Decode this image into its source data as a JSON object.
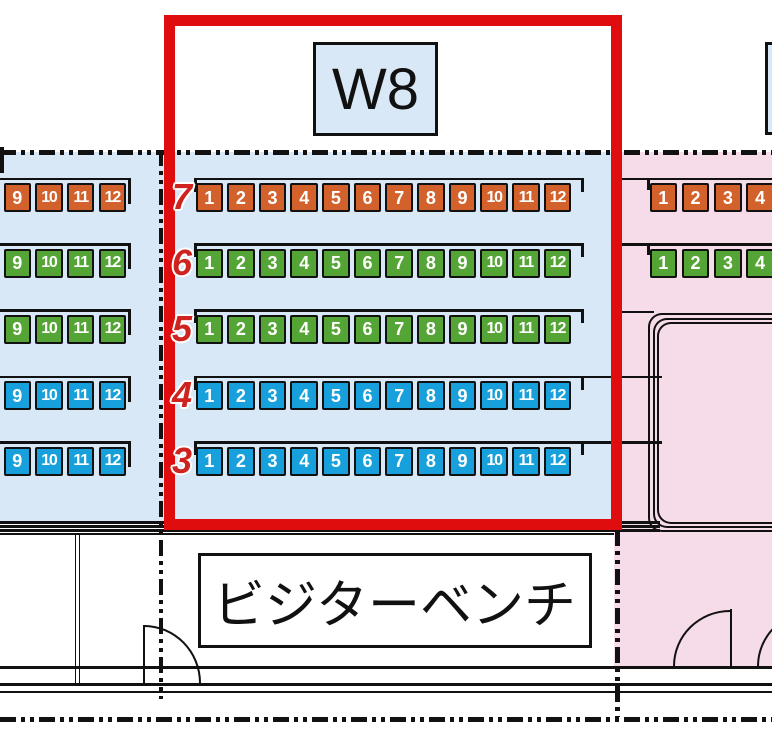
{
  "map": {
    "section_label": "W8",
    "bench_label": "ビジターベンチ",
    "row_numbers": [
      "7",
      "6",
      "5",
      "4",
      "3"
    ],
    "row_colors": [
      "orange",
      "green",
      "green",
      "blue",
      "blue"
    ],
    "left_seats": [
      "9",
      "10",
      "11",
      "12"
    ],
    "main_seats": [
      "1",
      "2",
      "3",
      "4",
      "5",
      "6",
      "7",
      "8",
      "9",
      "10",
      "11",
      "12"
    ],
    "right_seats": [
      "1",
      "2",
      "3",
      "4"
    ],
    "right_rows_present": [
      0,
      1
    ]
  },
  "colors": {
    "orange": "#d2612c",
    "green": "#55a536",
    "blue": "#17a0db",
    "stand_bg": "#d9e8f6",
    "right_bg": "#f6dbe8",
    "highlight": "#df0d0d",
    "row_label": "#ce231e",
    "line": "#111111"
  }
}
